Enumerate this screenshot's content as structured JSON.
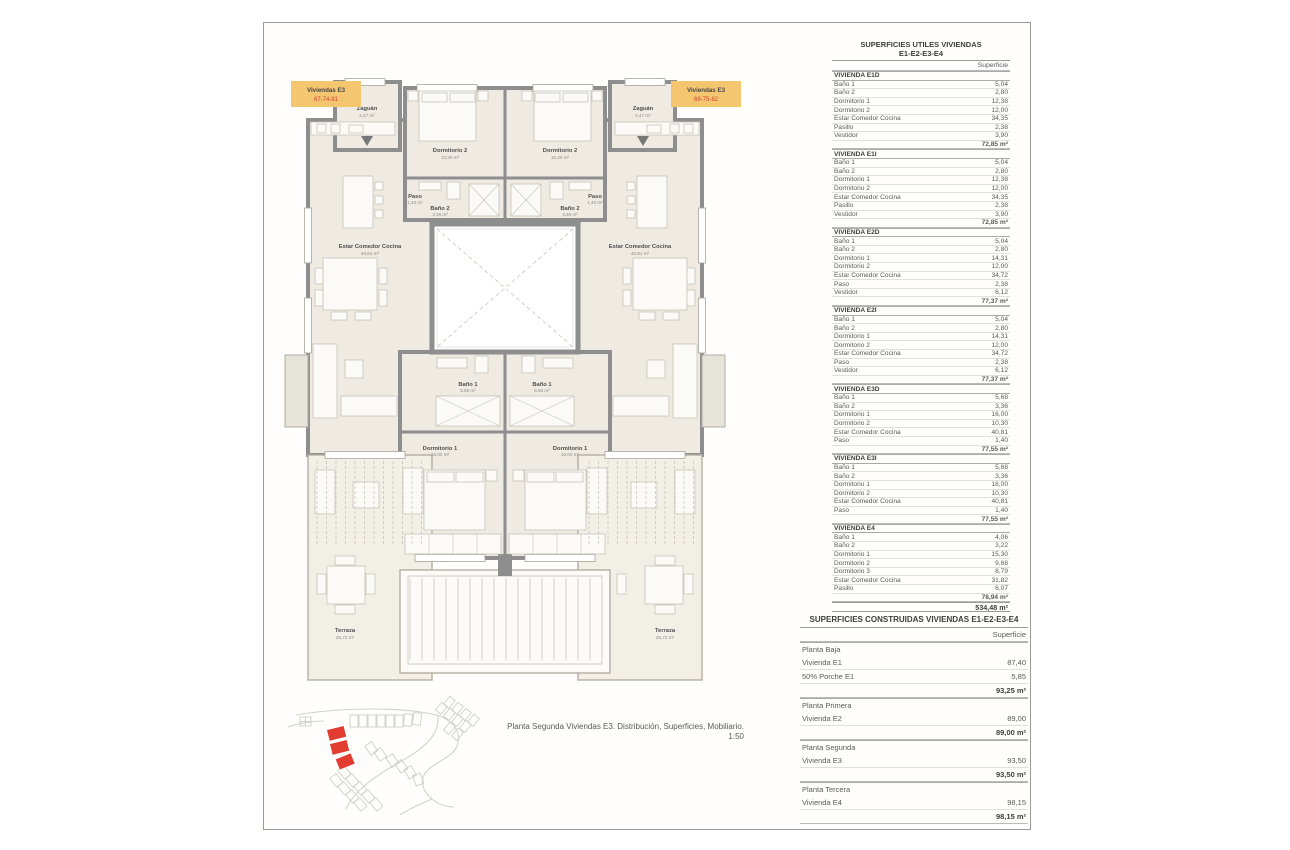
{
  "sheet": {
    "caption_line1": "Planta Segunda Viviendas E3. Distribución, Superficies, Mobiliario.",
    "caption_scale": "1:50"
  },
  "colors": {
    "unit_label_bg": "#f5c670",
    "unit_label_numbers": "#cf4233",
    "site_highlight": "#e23b30",
    "wall": "#8e8e8e",
    "floor": "#efebe2"
  },
  "plan": {
    "unit_labels": {
      "left": {
        "name": "Viviendas E3",
        "numbers": "67-74-81"
      },
      "right": {
        "name": "Viviendas E3",
        "numbers": "68-75-82"
      }
    },
    "rooms": {
      "zaguan": {
        "name": "Zaguán",
        "area": "2,47 m²"
      },
      "dormitorio2": {
        "name": "Dormitorio 2",
        "area": "10,30 m²"
      },
      "bano2": {
        "name": "Baño 2",
        "area": "3,36 m²"
      },
      "paso": {
        "name": "Paso",
        "area": "1,40 m²"
      },
      "estar": {
        "name": "Estar Comedor Cocina",
        "area": "40,81 m²"
      },
      "bano1": {
        "name": "Baño 1",
        "area": "5,68 m²"
      },
      "dormitorio1": {
        "name": "Dormitorio 1",
        "area": "16,00 m²"
      },
      "terraza": {
        "name": "Terraza",
        "area": "26,72 m²"
      }
    }
  },
  "useful_table": {
    "title_line1": "SUPERFICIES UTILES VIVIENDAS",
    "title_line2": "E1-E2-E3-E4",
    "col_header": "Superficie",
    "rows": [
      {
        "type": "section",
        "label": "VIVIENDA E1D",
        "value": ""
      },
      {
        "type": "item",
        "label": "Baño 1",
        "value": "5,04"
      },
      {
        "type": "item",
        "label": "Baño 2",
        "value": "2,80"
      },
      {
        "type": "item",
        "label": "Dormitorio 1",
        "value": "12,38"
      },
      {
        "type": "item",
        "label": "Dormitorio 2",
        "value": "12,00"
      },
      {
        "type": "item",
        "label": "Estar Comedor Cocina",
        "value": "34,35"
      },
      {
        "type": "item",
        "label": "Pasillo",
        "value": "2,38"
      },
      {
        "type": "item",
        "label": "Vestidor",
        "value": "3,90"
      },
      {
        "type": "total",
        "label": "",
        "value": "72,85 m²"
      },
      {
        "type": "section",
        "label": "VIVIENDA E1I",
        "value": ""
      },
      {
        "type": "item",
        "label": "Baño 1",
        "value": "5,04"
      },
      {
        "type": "item",
        "label": "Baño 2",
        "value": "2,80"
      },
      {
        "type": "item",
        "label": "Dormitorio 1",
        "value": "12,38"
      },
      {
        "type": "item",
        "label": "Dormitorio 2",
        "value": "12,00"
      },
      {
        "type": "item",
        "label": "Estar Comedor Cocina",
        "value": "34,35"
      },
      {
        "type": "item",
        "label": "Pasillo",
        "value": "2,38"
      },
      {
        "type": "item",
        "label": "Vestidor",
        "value": "3,90"
      },
      {
        "type": "total",
        "label": "",
        "value": "72,85 m²"
      },
      {
        "type": "section",
        "label": "VIVIENDA E2D",
        "value": ""
      },
      {
        "type": "item",
        "label": "Baño 1",
        "value": "5,04"
      },
      {
        "type": "item",
        "label": "Baño 2",
        "value": "2,80"
      },
      {
        "type": "item",
        "label": "Dormitorio 1",
        "value": "14,31"
      },
      {
        "type": "item",
        "label": "Dormitorio 2",
        "value": "12,00"
      },
      {
        "type": "item",
        "label": "Estar Comedor Cocina",
        "value": "34,72"
      },
      {
        "type": "item",
        "label": "Paso",
        "value": "2,38"
      },
      {
        "type": "item",
        "label": "Vestidor",
        "value": "6,12"
      },
      {
        "type": "total",
        "label": "",
        "value": "77,37 m²"
      },
      {
        "type": "section",
        "label": "VIVIENDA E2I",
        "value": ""
      },
      {
        "type": "item",
        "label": "Baño 1",
        "value": "5,04"
      },
      {
        "type": "item",
        "label": "Baño 2",
        "value": "2,80"
      },
      {
        "type": "item",
        "label": "Dormitorio 1",
        "value": "14,31"
      },
      {
        "type": "item",
        "label": "Dormitorio 2",
        "value": "12,00"
      },
      {
        "type": "item",
        "label": "Estar Comedor Cocina",
        "value": "34,72"
      },
      {
        "type": "item",
        "label": "Paso",
        "value": "2,38"
      },
      {
        "type": "item",
        "label": "Vestidor",
        "value": "6,12"
      },
      {
        "type": "total",
        "label": "",
        "value": "77,37 m²"
      },
      {
        "type": "section",
        "label": "VIVIENDA E3D",
        "value": ""
      },
      {
        "type": "item",
        "label": "Baño 1",
        "value": "5,68"
      },
      {
        "type": "item",
        "label": "Baño 2",
        "value": "3,36"
      },
      {
        "type": "item",
        "label": "Dormitorio 1",
        "value": "16,00"
      },
      {
        "type": "item",
        "label": "Dormitorio 2",
        "value": "10,30"
      },
      {
        "type": "item",
        "label": "Estar Comedor Cocina",
        "value": "40,81"
      },
      {
        "type": "item",
        "label": "Paso",
        "value": "1,40"
      },
      {
        "type": "total",
        "label": "",
        "value": "77,55 m²"
      },
      {
        "type": "section",
        "label": "VIVIENDA E3I",
        "value": ""
      },
      {
        "type": "item",
        "label": "Baño 1",
        "value": "5,68"
      },
      {
        "type": "item",
        "label": "Baño 2",
        "value": "3,36"
      },
      {
        "type": "item",
        "label": "Dormitorio 1",
        "value": "16,00"
      },
      {
        "type": "item",
        "label": "Dormitorio 2",
        "value": "10,30"
      },
      {
        "type": "item",
        "label": "Estar Comedor Cocina",
        "value": "40,81"
      },
      {
        "type": "item",
        "label": "Paso",
        "value": "1,40"
      },
      {
        "type": "total",
        "label": "",
        "value": "77,55 m²"
      },
      {
        "type": "section",
        "label": "VIVIENDA E4",
        "value": ""
      },
      {
        "type": "item",
        "label": "Baño 1",
        "value": "4,06"
      },
      {
        "type": "item",
        "label": "Baño 2",
        "value": "3,22"
      },
      {
        "type": "item",
        "label": "Dormitorio 1",
        "value": "15,30"
      },
      {
        "type": "item",
        "label": "Dormitorio 2",
        "value": "9,68"
      },
      {
        "type": "item",
        "label": "Dormitorio 3",
        "value": "8,79"
      },
      {
        "type": "item",
        "label": "Estar Comedor Cocina",
        "value": "31,82"
      },
      {
        "type": "item",
        "label": "Pasillo",
        "value": "6,07"
      },
      {
        "type": "total",
        "label": "",
        "value": "78,94 m²"
      },
      {
        "type": "grand",
        "label": "",
        "value": "534,48 m²"
      }
    ]
  },
  "built_table": {
    "title": "SUPERFICIES CONSTRUIDAS VIVIENDAS E1-E2-E3-E4",
    "col_header": "Superficie",
    "rows": [
      {
        "type": "group",
        "label": "Planta Baja",
        "value": ""
      },
      {
        "type": "item",
        "label": "Vivienda E1",
        "value": "87,40"
      },
      {
        "type": "item",
        "label": "50% Porche E1",
        "value": "5,85"
      },
      {
        "type": "subtotal",
        "label": "",
        "value": "93,25 m²"
      },
      {
        "type": "group",
        "label": "Planta Primera",
        "value": ""
      },
      {
        "type": "item",
        "label": "Vivienda E2",
        "value": "89,00"
      },
      {
        "type": "subtotal",
        "label": "",
        "value": "89,00 m²"
      },
      {
        "type": "group",
        "label": "Planta Segunda",
        "value": ""
      },
      {
        "type": "item",
        "label": "Vivienda E3",
        "value": "93,50"
      },
      {
        "type": "subtotal",
        "label": "",
        "value": "93,50 m²"
      },
      {
        "type": "group",
        "label": "Planta Tercera",
        "value": ""
      },
      {
        "type": "item",
        "label": "Vivienda E4",
        "value": "98,15"
      },
      {
        "type": "subtotal",
        "label": "",
        "value": "98,15 m²"
      }
    ]
  }
}
